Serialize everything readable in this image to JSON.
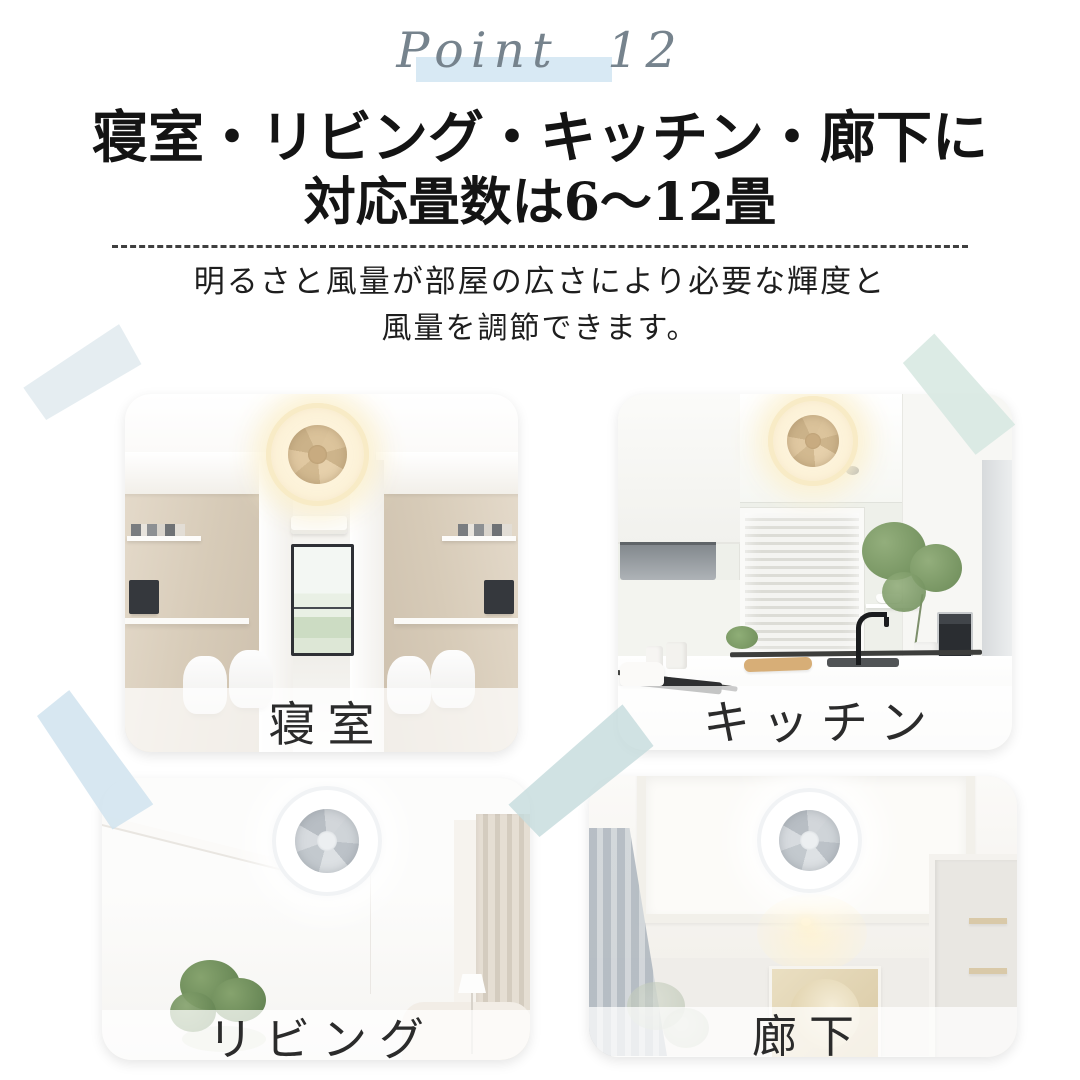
{
  "header": {
    "point_label": "Point 12",
    "title_line1": "寝室・リビング・キッチン・廊下に",
    "title_line2": "対応畳数は6〜12畳",
    "subtitle_line1": "明るさと風量が部屋の広さにより必要な輝度と",
    "subtitle_line2": "風量を調節できます。"
  },
  "rooms": [
    {
      "id": "bedroom",
      "label": "寝室"
    },
    {
      "id": "kitchen",
      "label": "キッチン"
    },
    {
      "id": "living",
      "label": "リビング"
    },
    {
      "id": "hallway",
      "label": "廊下"
    }
  ],
  "colors": {
    "point_text": "#76838d",
    "point_highlight": "#d8e9f4",
    "heading_text": "#141414",
    "tape_blue": "#dce9f0",
    "tape_green": "#d6e7e0"
  }
}
